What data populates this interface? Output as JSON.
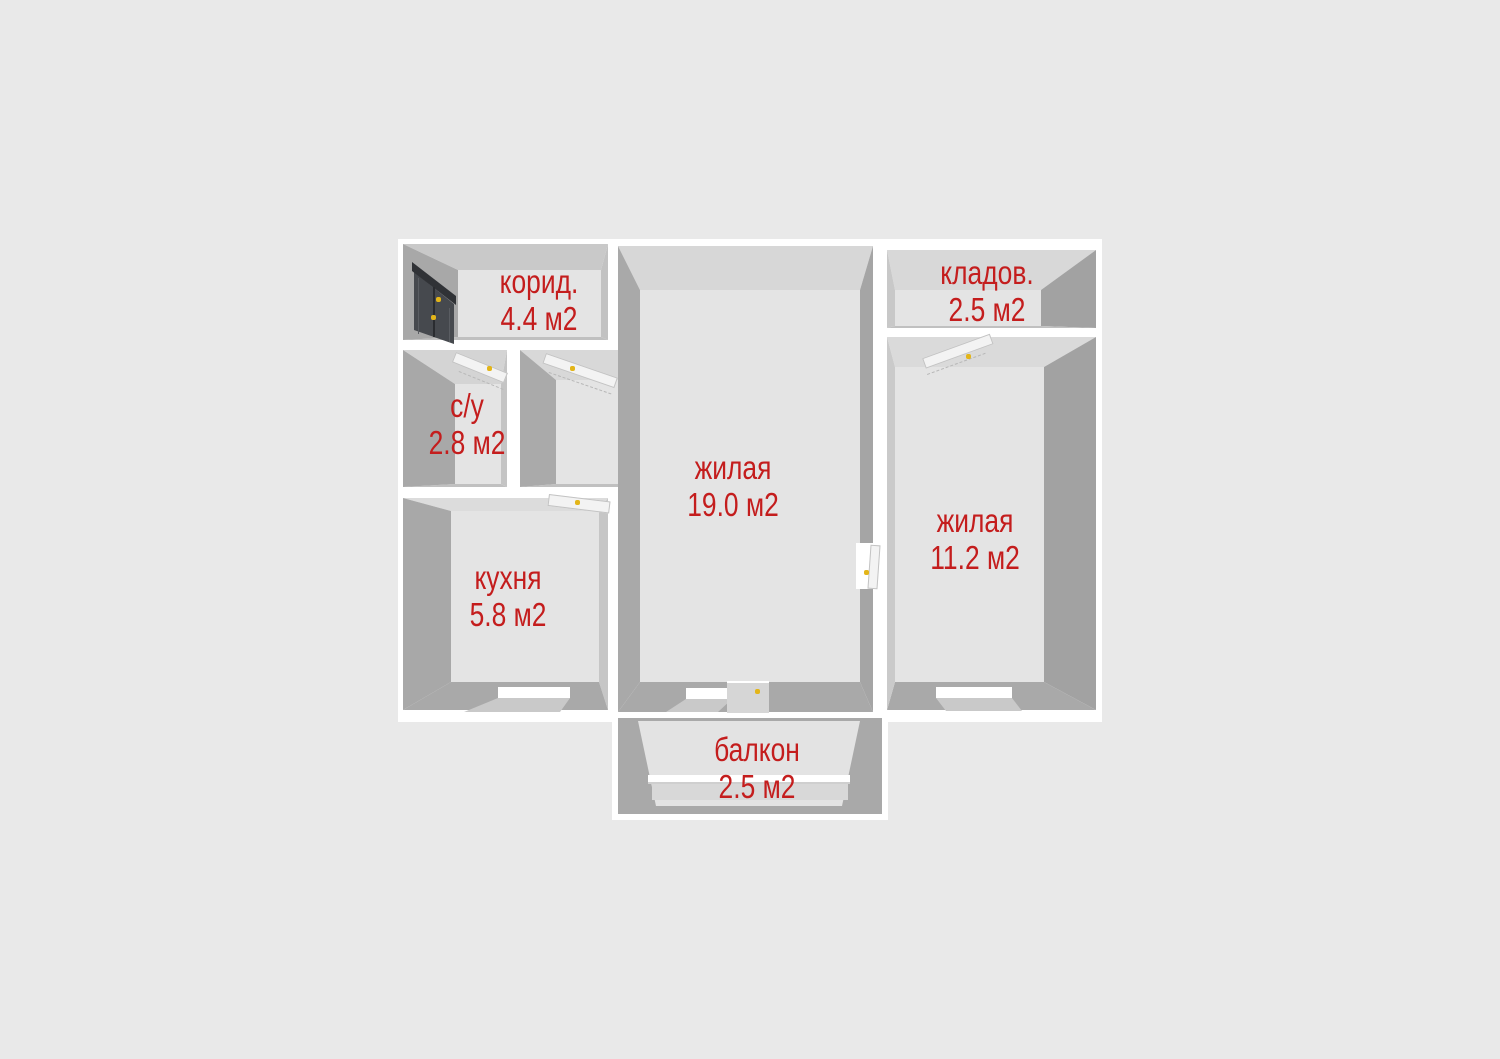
{
  "palette": {
    "background": "#e9e9e9",
    "wall": "#ffffff",
    "label_color": "#c41d1d",
    "handle_color": "#e3b519",
    "floor": "#e4e4e4"
  },
  "rooms": {
    "corridor": {
      "name": "корид.",
      "area": "4.4 м2"
    },
    "bathroom": {
      "name": "с/у",
      "area": "2.8 м2"
    },
    "kitchen": {
      "name": "кухня",
      "area": "5.8 м2"
    },
    "living": {
      "name": "жилая",
      "area": "19.0 м2"
    },
    "bedroom": {
      "name": "жилая",
      "area": "11.2 м2"
    },
    "storage": {
      "name": "кладов.",
      "area": "2.5 м2"
    },
    "balcony": {
      "name": "балкон",
      "area": "2.5 м2"
    }
  }
}
